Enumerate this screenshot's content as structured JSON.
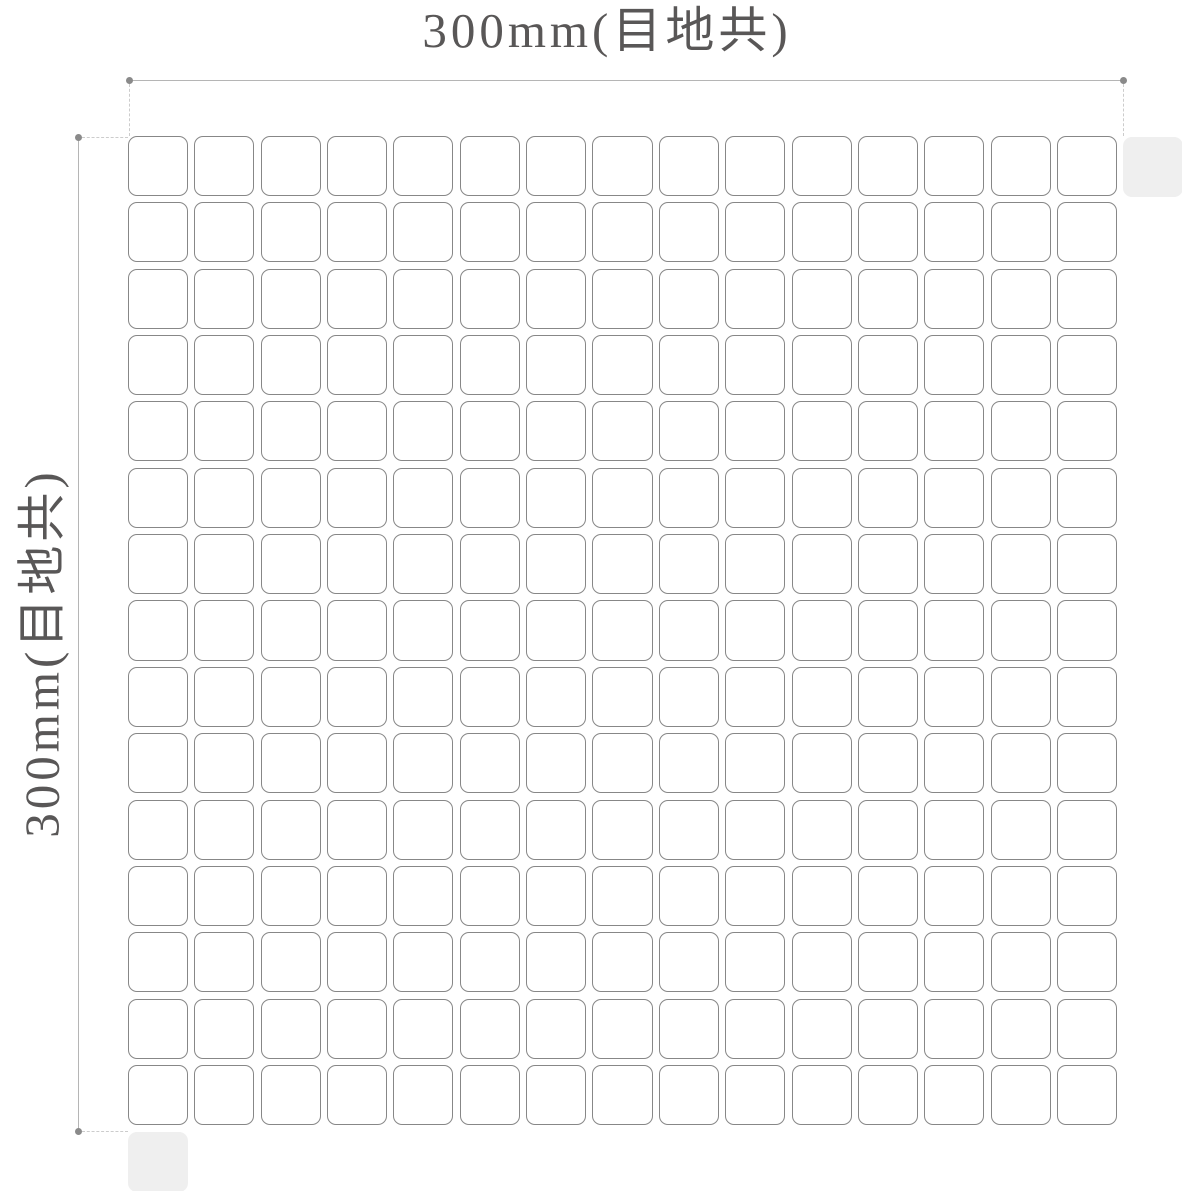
{
  "diagram": {
    "type": "mosaic-tile-sheet-dimension-drawing",
    "top_dimension": {
      "label": "300mm(目地共)"
    },
    "left_dimension": {
      "label": "300mm(目地共)"
    },
    "tile_grid": {
      "rows": 15,
      "columns": 15,
      "total_tiles": 225
    },
    "adjacent_sheet_tiles": {
      "count": 2,
      "positions": [
        "top-right",
        "bottom-left"
      ]
    },
    "colors": {
      "background": "#ffffff",
      "tile_fill": "#ffffff",
      "tile_border": "#878787",
      "adjacent_tile_fill": "#efefef",
      "dimension_line": "#b5b5b5",
      "dimension_dot": "#8a8a8a",
      "extension_line_dashed": "#cccccc",
      "label_text": "#595757"
    }
  }
}
